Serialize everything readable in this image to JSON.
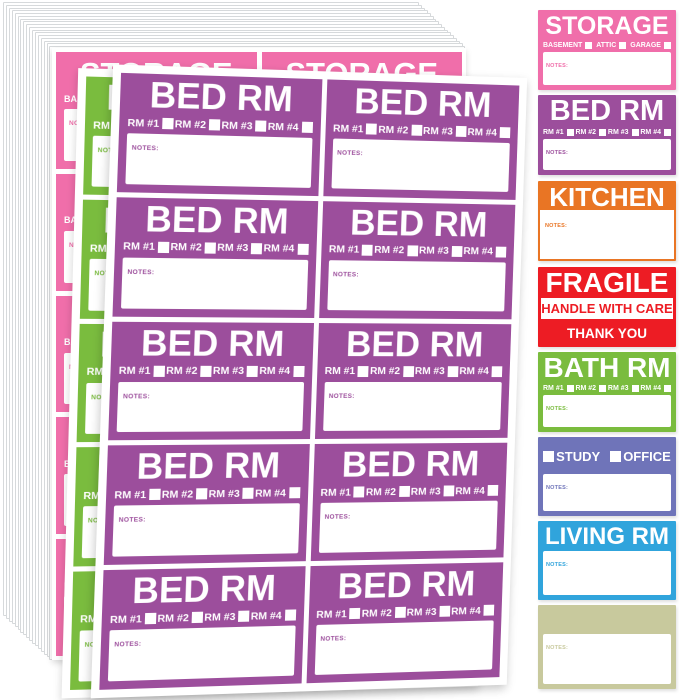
{
  "notes_label": "NOTES:",
  "colors": {
    "pink": "#f06eaa",
    "purple": "#9c4e9c",
    "green": "#7abc3e",
    "orange": "#e97524",
    "red": "#ed1c24",
    "periwinkle": "#6f74b9",
    "blue": "#30a4dc",
    "khaki": "#c8c99d"
  },
  "sheets": [
    {
      "id": "storage",
      "title": "STORAGE",
      "color_key": "pink",
      "checkboxes": [
        "BASEMENT",
        "ATTIC",
        "GARAGE"
      ],
      "columns": 2,
      "rows": 5
    },
    {
      "id": "bath",
      "title": "BATH RM",
      "color_key": "green",
      "checkboxes": [
        "RM #1",
        "RM #2",
        "RM #3",
        "RM #4"
      ],
      "columns": 2,
      "rows": 5
    },
    {
      "id": "bed",
      "title": "BED RM",
      "color_key": "purple",
      "checkboxes": [
        "RM #1",
        "RM #2",
        "RM #3",
        "RM #4"
      ],
      "columns": 2,
      "rows": 5
    }
  ],
  "samples": [
    {
      "id": "storage",
      "type": "room",
      "title": "STORAGE",
      "color_key": "pink",
      "checkboxes": [
        "BASEMENT",
        "ATTIC",
        "GARAGE"
      ]
    },
    {
      "id": "bed-rm",
      "type": "room",
      "title": "BED RM",
      "color_key": "purple",
      "checkboxes": [
        "RM #1",
        "RM #2",
        "RM #3",
        "RM #4"
      ]
    },
    {
      "id": "kitchen",
      "type": "header",
      "title": "KITCHEN",
      "color_key": "orange"
    },
    {
      "id": "fragile",
      "type": "fragile",
      "title": "FRAGILE",
      "subtitle": "HANDLE WITH CARE",
      "footer": "THANK YOU",
      "color_key": "red"
    },
    {
      "id": "bath-rm",
      "type": "room",
      "title": "BATH RM",
      "color_key": "green",
      "checkboxes": [
        "RM #1",
        "RM #2",
        "RM #3",
        "RM #4"
      ]
    },
    {
      "id": "study-office",
      "type": "options",
      "options": [
        "STUDY",
        "OFFICE"
      ],
      "color_key": "periwinkle"
    },
    {
      "id": "living-rm",
      "type": "title-notes",
      "title": "LIVING RM",
      "color_key": "blue"
    },
    {
      "id": "blank",
      "type": "blank",
      "color_key": "khaki"
    }
  ]
}
